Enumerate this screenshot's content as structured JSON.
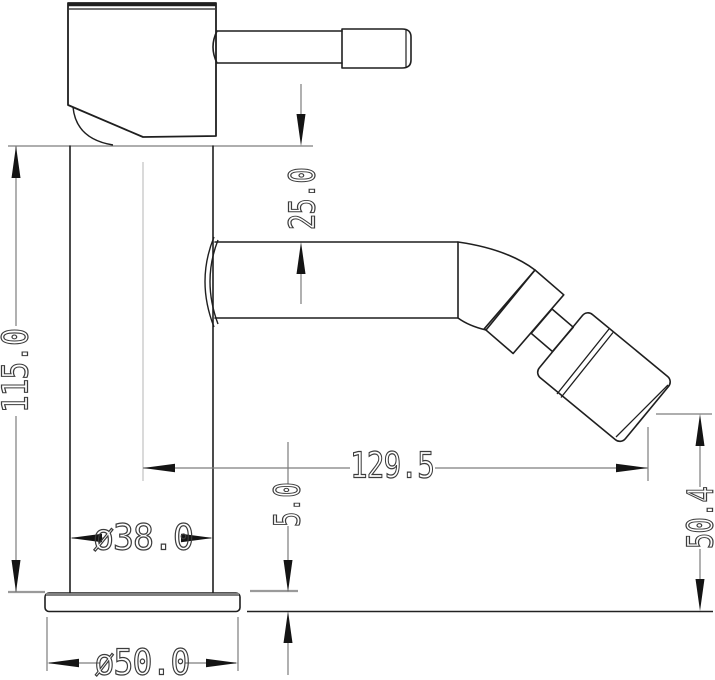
{
  "drawing": {
    "kind": "faucet-dimension-drawing",
    "colors": {
      "background": "#ffffff",
      "outline": "#1f1f1f",
      "dimension_lines": "#7d7d7d",
      "labels": "#3c3c3c",
      "centerline": "#b5b5b5",
      "plate_edge": "#808080"
    }
  },
  "dimensions": [
    {
      "id": "overall-height",
      "label": "115.0"
    },
    {
      "id": "top-to-spout",
      "label": "25.0"
    },
    {
      "id": "spout-reach",
      "label": "129.5"
    },
    {
      "id": "outlet-height",
      "label": "50.4"
    },
    {
      "id": "base-thickness",
      "label": "5.0"
    },
    {
      "id": "body-diameter",
      "label": "ø38.0"
    },
    {
      "id": "base-diameter",
      "label": "ø50.0"
    }
  ]
}
